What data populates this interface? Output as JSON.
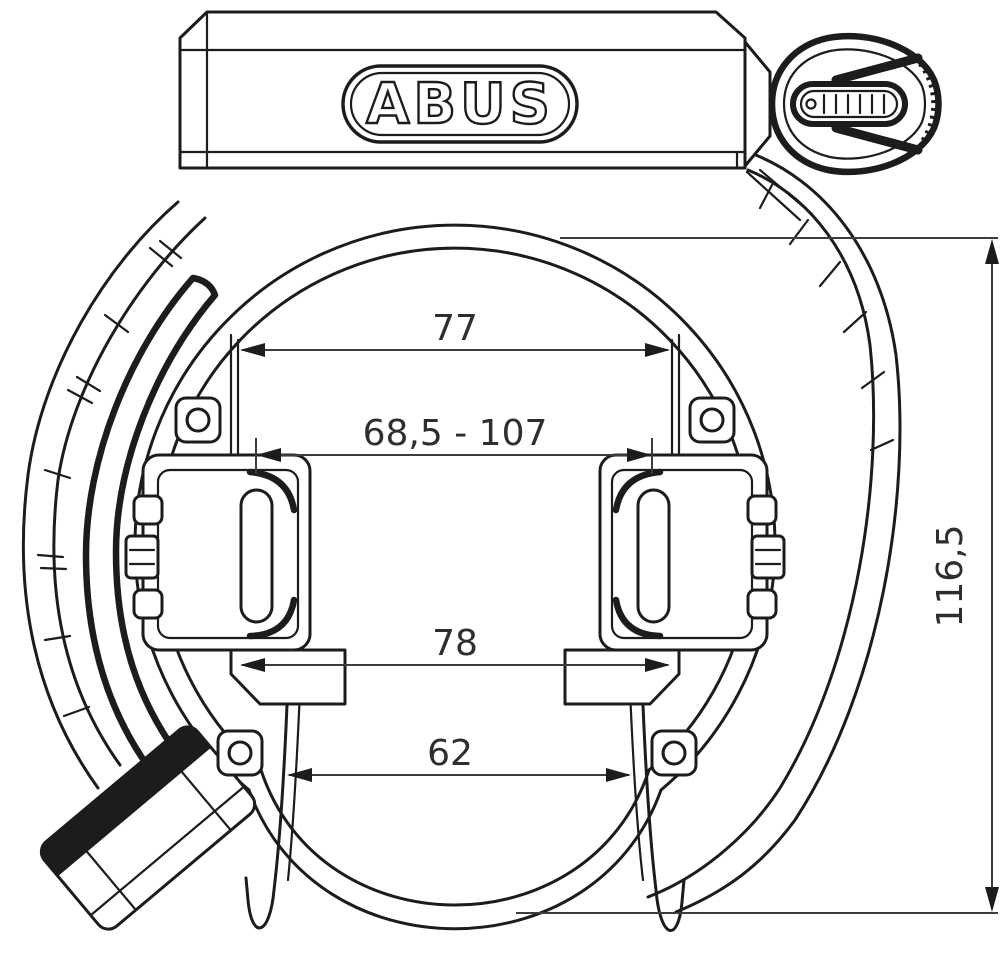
{
  "brand": {
    "logo_text": "ABUS"
  },
  "dimensions": {
    "top_width": "77",
    "mounting_range": "68,5 - 107",
    "mid_width": "78",
    "opening_width": "62",
    "overall_height": "116,5"
  },
  "colors": {
    "line": "#1c1c1c",
    "dimension_line": "#3c3c3c",
    "text": "#2e2e2e",
    "background": "#ffffff"
  }
}
